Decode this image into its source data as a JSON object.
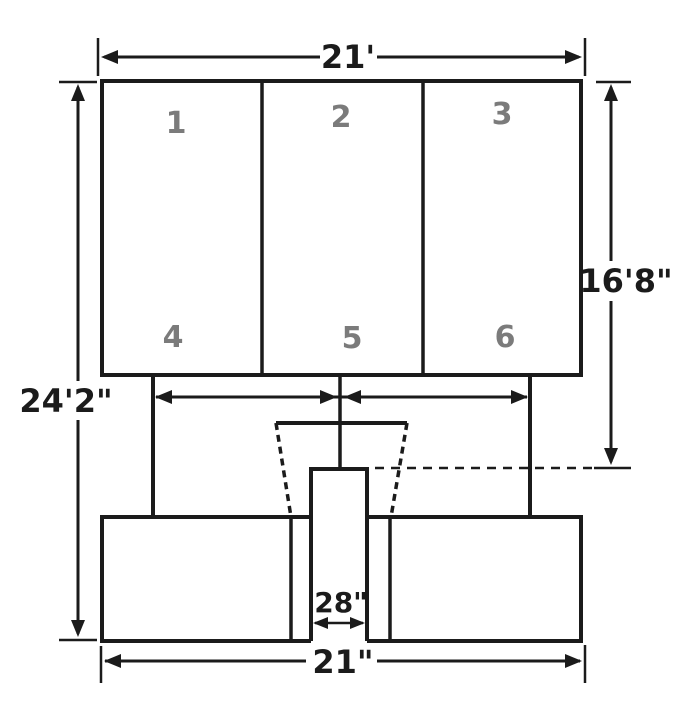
{
  "figure": {
    "type": "dimensioned elevation drawing",
    "subject": "three-panel sign structure on center pole with footing",
    "panels": [
      "1",
      "2",
      "3",
      "4",
      "5",
      "6"
    ],
    "dimensions": {
      "top": "21'",
      "left": "24'2\"",
      "right": "16'8\"",
      "pole": "28\"",
      "bottom": "21\""
    },
    "colors": {
      "line": "#1b1b1b",
      "panel_number": "#7b7b7b",
      "background": "#ffffff"
    }
  }
}
